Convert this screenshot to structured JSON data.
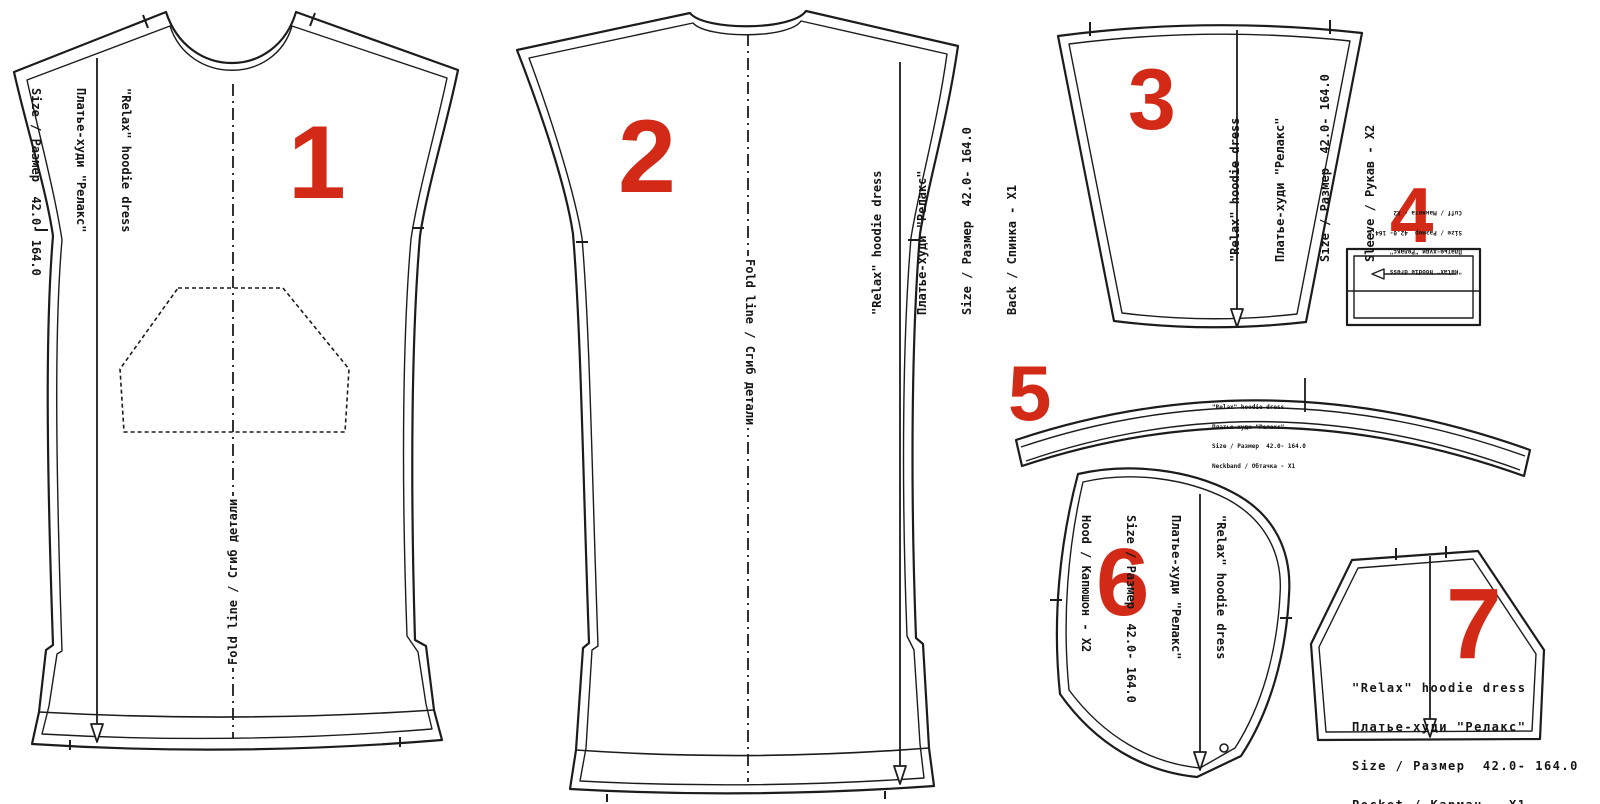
{
  "pattern": {
    "name_en": "\"Relax\" hoodie dress",
    "name_ru": "Платье-худи \"Релакс\"",
    "size_line": "Size / Размер  42.0- 164.0"
  },
  "fold_line_label": "Fold line / Сгиб детали",
  "colors": {
    "line": "#1c1c1c",
    "number_red": "#d22a16",
    "background": "#ffffff"
  },
  "pieces": [
    {
      "number": "1",
      "lines": [
        "\"Relax\" hoodie dress",
        "Платье-худи \"Релакс\"",
        "Size / Размер  42.0- 164.0",
        "Front / Перед - X1"
      ]
    },
    {
      "number": "2",
      "lines": [
        "\"Relax\" hoodie dress",
        "Платье-худи \"Релакс\"",
        "Size / Размер  42.0- 164.0",
        "Back / Спинка - X1"
      ]
    },
    {
      "number": "3",
      "lines": [
        "\"Relax\" hoodie dress",
        "Платье-худи \"Релакс\"",
        "Size / Размер  42.0- 164.0",
        "Sleeve / Рукав - X2"
      ]
    },
    {
      "number": "4",
      "lines": [
        "\"Relax\" hoodie dress",
        "Платье-худи \"Релакс\"",
        "Size / Размер  42.0- 164.0",
        "Cuff / Манжета - X2"
      ]
    },
    {
      "number": "5",
      "lines": [
        "\"Relax\" hoodie dress",
        "Платье-худи \"Релакс\"",
        "Size / Размер  42.0- 164.0",
        "Neckband / Обтачка - X1"
      ]
    },
    {
      "number": "6",
      "lines": [
        "\"Relax\" hoodie dress",
        "Платье-худи \"Релакс\"",
        "Size / Размер  42.0- 164.0",
        "Hood / Капюшон - X2"
      ]
    },
    {
      "number": "7",
      "lines": [
        "\"Relax\" hoodie dress",
        "Платье-худи \"Релакс\"",
        "Size / Размер  42.0- 164.0",
        "Pocket / Карман - X1"
      ]
    }
  ]
}
